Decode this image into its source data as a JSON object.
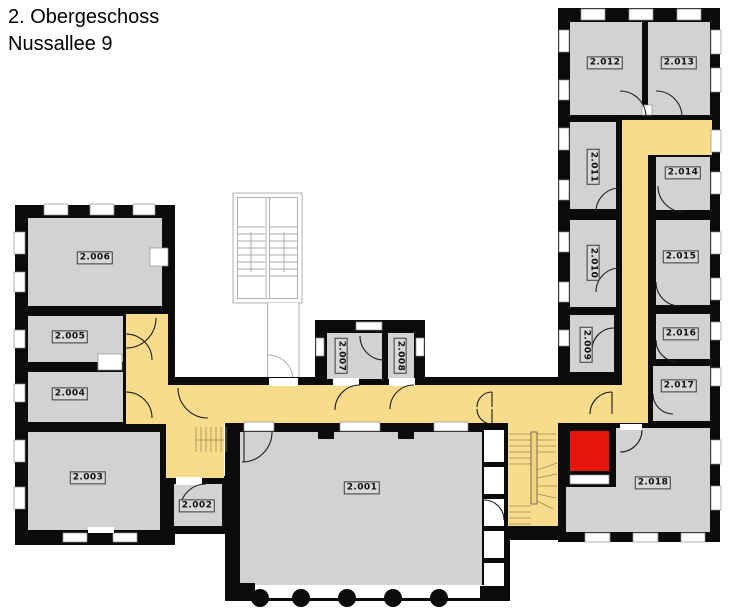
{
  "title": {
    "line1": "2. Obergeschoss",
    "line2": "Nussallee 9"
  },
  "rooms": {
    "r2_001": "2.001",
    "r2_002": "2.002",
    "r2_003": "2.003",
    "r2_004": "2.004",
    "r2_005": "2.005",
    "r2_006": "2.006",
    "r2_007": "2.007",
    "r2_008": "2.008",
    "r2_009": "2.009",
    "r2_010": "2.010",
    "r2_011": "2.011",
    "r2_012": "2.012",
    "r2_013": "2.013",
    "r2_014": "2.014",
    "r2_015": "2.015",
    "r2_016": "2.016",
    "r2_017": "2.017",
    "r2_018": "2.018"
  },
  "colors": {
    "room": "#d2d2d2",
    "corridor": "#f8dc8c",
    "highlight": "#e8150b",
    "wall": "#0b0b0b",
    "outline": "#a9a9a9"
  }
}
